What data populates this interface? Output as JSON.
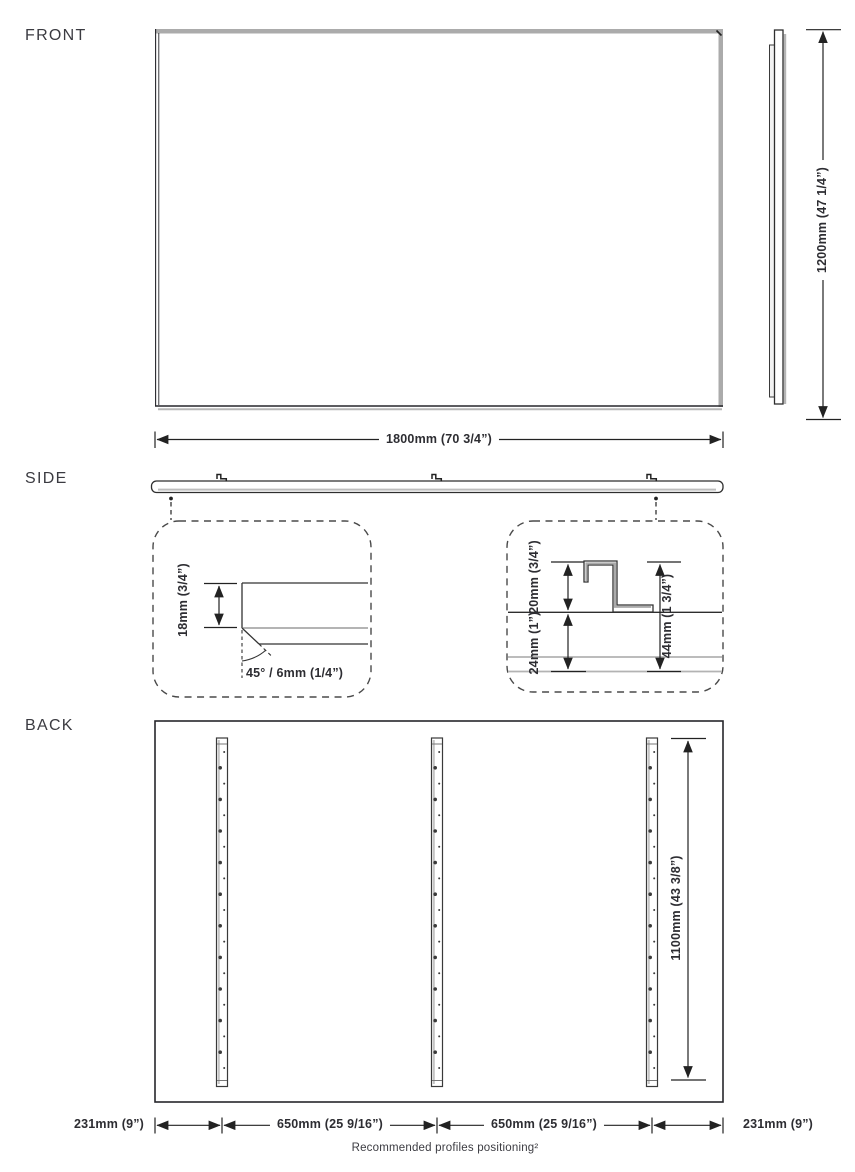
{
  "front_view": {
    "label": "FRONT",
    "width_dim": "1800mm (70 3/4”)",
    "height_dim": "1200mm (47 1/4”)"
  },
  "side_view": {
    "label": "SIDE",
    "edge_detail": {
      "panel_thickness_dim": "18mm (3/4”)",
      "chamfer_dim": "45° / 6mm (1/4”)"
    },
    "profile_detail": {
      "profile_height_dim": "20mm (3/4”)",
      "panel_depth_dim": "24mm (1”)",
      "total_depth_dim": "44mm (1 3/4”)"
    }
  },
  "back_view": {
    "label": "BACK",
    "profile_length_dim": "1100mm (43 3/8”)",
    "bottom_dims": {
      "left_margin": "231mm (9”)",
      "left_span": "650mm (25 9/16”)",
      "right_span": "650mm (25 9/16”)",
      "right_margin": "231mm (9”)"
    },
    "footnote": "Recommended profiles positioning²"
  }
}
